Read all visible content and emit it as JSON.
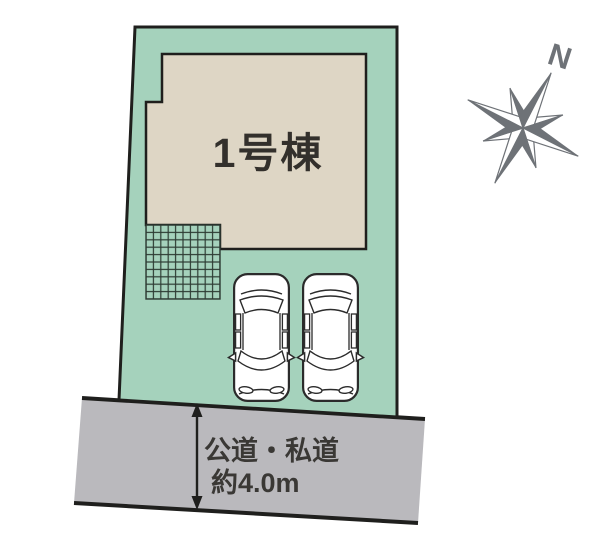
{
  "plan": {
    "building": {
      "label": "1号棟"
    },
    "road": {
      "type_label": "公道・私道",
      "width_label": "約4.0m"
    },
    "compass": {
      "north_label": "N"
    },
    "parking": {
      "car_count": 2
    },
    "colors": {
      "parcel": "#a5d2bc",
      "building": "#ded6c5",
      "road": "#bab9bd",
      "outline": "#1f1f1d",
      "compass": "#6e7277",
      "grid_line": "#2d3b33",
      "text": "#33302c"
    }
  }
}
